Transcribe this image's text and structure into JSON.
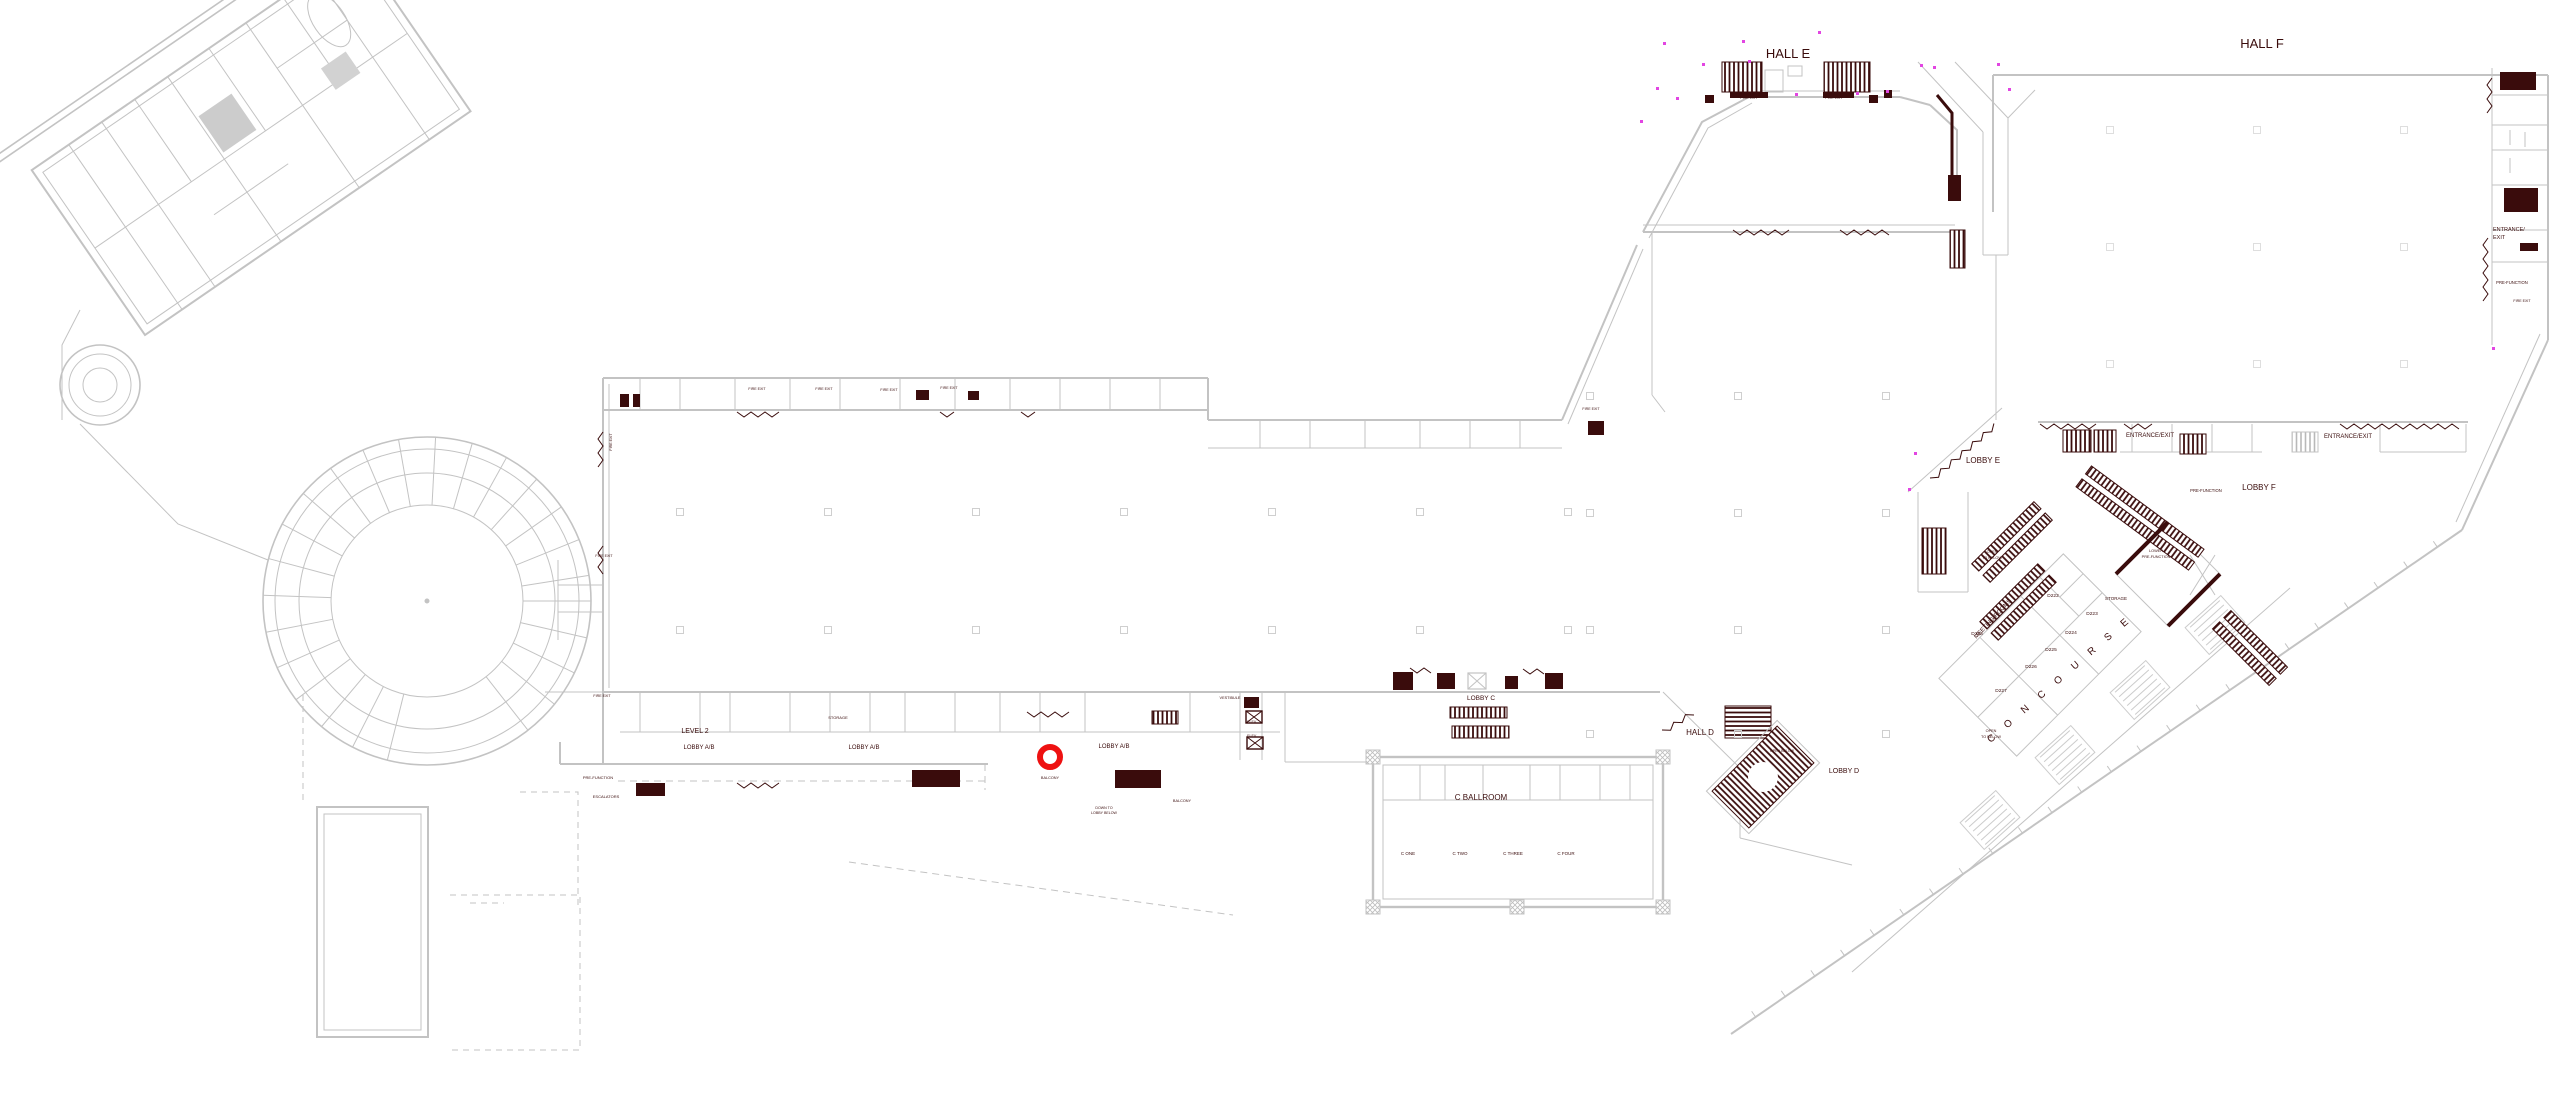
{
  "palette": {
    "wall_gray": "#c3c3c3",
    "wall_faint": "#d9d9d9",
    "ink_maroon": "#3a0c0c",
    "magenta": "#e245e2",
    "annotation_red": "#ee1111"
  },
  "annotation": {
    "name": "highlight-circle",
    "cx": 1050,
    "cy": 757,
    "r": 10,
    "stroke_width": 6
  },
  "labels": [
    {
      "id": "hall-e",
      "text": "HALL E",
      "x": 1788,
      "y": 58,
      "s": 13
    },
    {
      "id": "hall-f",
      "text": "HALL F",
      "x": 2262,
      "y": 48,
      "s": 13
    },
    {
      "id": "lobby-e",
      "text": "LOBBY E",
      "x": 1983,
      "y": 463,
      "s": 8
    },
    {
      "id": "lobby-f",
      "text": "LOBBY F",
      "x": 2259,
      "y": 490,
      "s": 8
    },
    {
      "id": "entrance-exit-1",
      "text": "ENTRANCE/EXIT",
      "x": 2150,
      "y": 437,
      "s": 6
    },
    {
      "id": "entrance-exit-2",
      "text": "ENTRANCE/EXIT",
      "x": 2348,
      "y": 438,
      "s": 6
    },
    {
      "id": "entrance-exit-3a",
      "text": "ENTRANCE/",
      "x": 2493,
      "y": 231,
      "s": 5.5,
      "anchor": "start"
    },
    {
      "id": "entrance-exit-3b",
      "text": "EXIT",
      "x": 2493,
      "y": 239,
      "s": 5.5,
      "anchor": "start"
    },
    {
      "id": "pre-function-1",
      "text": "PRE-FUNCTION",
      "x": 2206,
      "y": 492,
      "s": 4.2
    },
    {
      "id": "pre-function-2",
      "text": "PRE-FUNCTION",
      "x": 2512,
      "y": 284,
      "s": 4.2
    },
    {
      "id": "pre-function-3",
      "text": "PRE-FUNCTION",
      "x": 598,
      "y": 779,
      "s": 4
    },
    {
      "id": "escalators",
      "text": "ESCALATORS",
      "x": 606,
      "y": 798,
      "s": 4
    },
    {
      "id": "lower-pre-function-a",
      "text": "LOWER",
      "x": 2156,
      "y": 552,
      "s": 3.8
    },
    {
      "id": "lower-pre-function-b",
      "text": "PRE-FUNCTION",
      "x": 2156,
      "y": 558,
      "s": 3.8
    },
    {
      "id": "open-to-below-1a",
      "text": "OPEN",
      "x": 1992,
      "y": 553,
      "s": 3.8
    },
    {
      "id": "open-to-below-1b",
      "text": "TO BELOW",
      "x": 1992,
      "y": 559,
      "s": 3.8
    },
    {
      "id": "open-to-below-2a",
      "text": "OPEN",
      "x": 1991,
      "y": 732,
      "s": 3.8
    },
    {
      "id": "open-to-below-2b",
      "text": "TO BELOW",
      "x": 1991,
      "y": 738,
      "s": 3.8
    },
    {
      "id": "open-below",
      "text": "OPEN BELOW",
      "x": 1782,
      "y": 752,
      "s": 3.6
    },
    {
      "id": "concourse",
      "text": "C O N C O U R S E",
      "x": 2062,
      "y": 681,
      "s": 10,
      "rot": -41,
      "ls": 6
    },
    {
      "id": "meeting-rooms",
      "text": "MEETING ROOMS",
      "x": 1994,
      "y": 620,
      "s": 6,
      "rot": -47
    },
    {
      "id": "storage-1",
      "text": "STORAGE",
      "x": 2116,
      "y": 600,
      "s": 4.5
    },
    {
      "id": "storage-2",
      "text": "STORAGE",
      "x": 838,
      "y": 719,
      "s": 4
    },
    {
      "id": "room-d222",
      "text": "D222",
      "x": 2053,
      "y": 597,
      "s": 4.8
    },
    {
      "id": "room-d223",
      "text": "D223",
      "x": 2092,
      "y": 615,
      "s": 4.8
    },
    {
      "id": "room-d224",
      "text": "D224",
      "x": 2071,
      "y": 634,
      "s": 4.8
    },
    {
      "id": "room-d225",
      "text": "D225",
      "x": 2051,
      "y": 651,
      "s": 4.8
    },
    {
      "id": "room-d226",
      "text": "D226",
      "x": 2031,
      "y": 668,
      "s": 4.8
    },
    {
      "id": "room-d227",
      "text": "D227",
      "x": 2001,
      "y": 692,
      "s": 4.8
    },
    {
      "id": "room-d228",
      "text": "D228",
      "x": 1977,
      "y": 635,
      "s": 4.8
    },
    {
      "id": "hall-d",
      "text": "HALL D",
      "x": 1700,
      "y": 735,
      "s": 8
    },
    {
      "id": "lobby-d",
      "text": "LOBBY D",
      "x": 1844,
      "y": 773,
      "s": 7
    },
    {
      "id": "lobby-c",
      "text": "LOBBY C",
      "x": 1481,
      "y": 700,
      "s": 6.5
    },
    {
      "id": "c-ballroom",
      "text": "C BALLROOM",
      "x": 1481,
      "y": 800,
      "s": 8
    },
    {
      "id": "c-one",
      "text": "C ONE",
      "x": 1408,
      "y": 855,
      "s": 4.5
    },
    {
      "id": "c-two",
      "text": "C TWO",
      "x": 1460,
      "y": 855,
      "s": 4.5
    },
    {
      "id": "c-three",
      "text": "C THREE",
      "x": 1513,
      "y": 855,
      "s": 4.5
    },
    {
      "id": "c-four",
      "text": "C FOUR",
      "x": 1566,
      "y": 855,
      "s": 4.5
    },
    {
      "id": "level-2",
      "text": "LEVEL 2",
      "x": 695,
      "y": 733,
      "s": 7
    },
    {
      "id": "lobby-ab-1",
      "text": "LOBBY A/B",
      "x": 699,
      "y": 749,
      "s": 6
    },
    {
      "id": "lobby-ab-2",
      "text": "LOBBY A/B",
      "x": 864,
      "y": 749,
      "s": 6
    },
    {
      "id": "lobby-ab-3",
      "text": "LOBBY A/B",
      "x": 1114,
      "y": 748,
      "s": 6
    },
    {
      "id": "vestibule",
      "text": "VESTIBULE",
      "x": 1230,
      "y": 699,
      "s": 3.8
    },
    {
      "id": "elev-1",
      "text": "ELEV.",
      "x": 1252,
      "y": 723,
      "s": 3.6
    },
    {
      "id": "elev-2",
      "text": "ELEV.",
      "x": 1252,
      "y": 737,
      "s": 3.6
    },
    {
      "id": "balcony-1",
      "text": "BALCONY",
      "x": 1050,
      "y": 779,
      "s": 3.8
    },
    {
      "id": "balcony-2",
      "text": "BALCONY",
      "x": 1182,
      "y": 802,
      "s": 3.8
    },
    {
      "id": "down-to-lobby-a",
      "text": "DOWN TO",
      "x": 1104,
      "y": 809,
      "s": 3.6
    },
    {
      "id": "down-to-lobby-b",
      "text": "LOBBY BELOW",
      "x": 1104,
      "y": 814,
      "s": 3.6
    },
    {
      "id": "fire-exit-1",
      "text": "FIRE EXIT",
      "x": 1749,
      "y": 99,
      "s": 3.6
    },
    {
      "id": "fire-exit-2",
      "text": "FIRE EXIT",
      "x": 1834,
      "y": 99,
      "s": 3.6
    },
    {
      "id": "fire-exit-3",
      "text": "FIRE EXIT",
      "x": 757,
      "y": 390,
      "s": 3.6
    },
    {
      "id": "fire-exit-4",
      "text": "FIRE EXIT",
      "x": 824,
      "y": 390,
      "s": 3.6
    },
    {
      "id": "fire-exit-5",
      "text": "FIRE EXIT",
      "x": 889,
      "y": 391,
      "s": 3.6
    },
    {
      "id": "fire-exit-6",
      "text": "FIRE EXIT",
      "x": 949,
      "y": 389,
      "s": 3.6
    },
    {
      "id": "fire-exit-7",
      "text": "FIRE EXIT",
      "x": 604,
      "y": 557,
      "s": 3.6
    },
    {
      "id": "fire-exit-8",
      "text": "FIRE EXIT",
      "x": 602,
      "y": 697,
      "s": 3.6
    },
    {
      "id": "fire-exit-9",
      "text": "FIRE EXIT",
      "x": 1591,
      "y": 410,
      "s": 3.6
    },
    {
      "id": "fire-exit-10",
      "text": "FIRE EXIT",
      "x": 612,
      "y": 442,
      "s": 3.6,
      "rot": -90
    },
    {
      "id": "fire-exit-11",
      "text": "FIRE EXIT",
      "x": 2522,
      "y": 302,
      "s": 3.6
    }
  ]
}
